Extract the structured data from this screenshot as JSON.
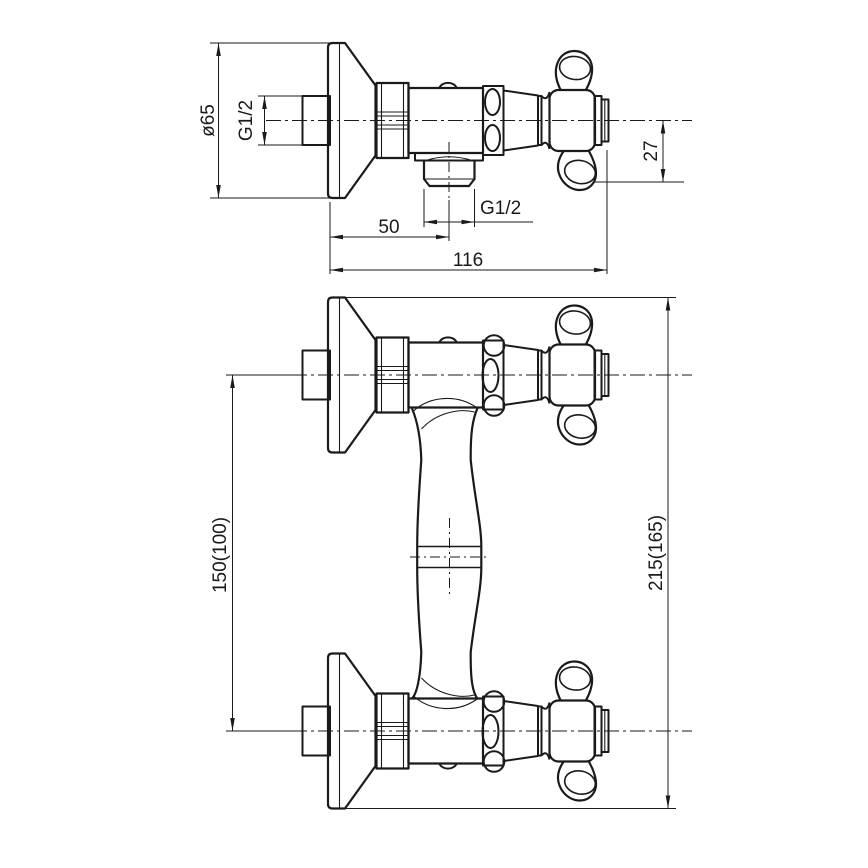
{
  "drawing": {
    "type": "technical dimension drawing",
    "subject": "Wall-mounted shower mixer valve with cross handle, two orthographic views",
    "background_color": "#ffffff",
    "line_color": "#1a1a1a",
    "views": [
      {
        "id": "detail-view",
        "description": "single valve side view with wall flange, outlet and cross handle"
      },
      {
        "id": "assembly-view",
        "description": "two wall connections joined by a column, cross handles at right"
      }
    ],
    "dimensions": {
      "flange_diameter": "ø65",
      "inlet_thread": "G1/2",
      "handle_offset": "27",
      "outlet_thread": "G1/2",
      "outlet_center_from_wall": "50",
      "overall_depth": "116",
      "connection_spacing": "150(100)",
      "overall_height": "215(165)"
    }
  }
}
